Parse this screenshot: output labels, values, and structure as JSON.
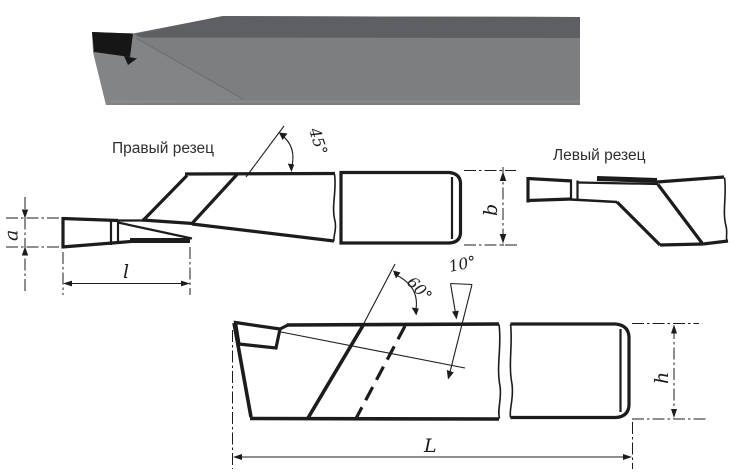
{
  "labels": {
    "right_cutter": "Правый резец",
    "left_cutter": "Левый  резец"
  },
  "angles": {
    "deg45": "45°",
    "deg60": "60°",
    "deg10": "10°"
  },
  "dims": {
    "a": "a",
    "b": "b",
    "l": "l",
    "h": "h",
    "L": "L"
  },
  "colors": {
    "outline": "#1c1c1c",
    "top_face": "#5d5f62",
    "front_face": "#7d7e80",
    "angled_face": "#87888a",
    "insert": "#161616",
    "background": "#ffffff"
  }
}
